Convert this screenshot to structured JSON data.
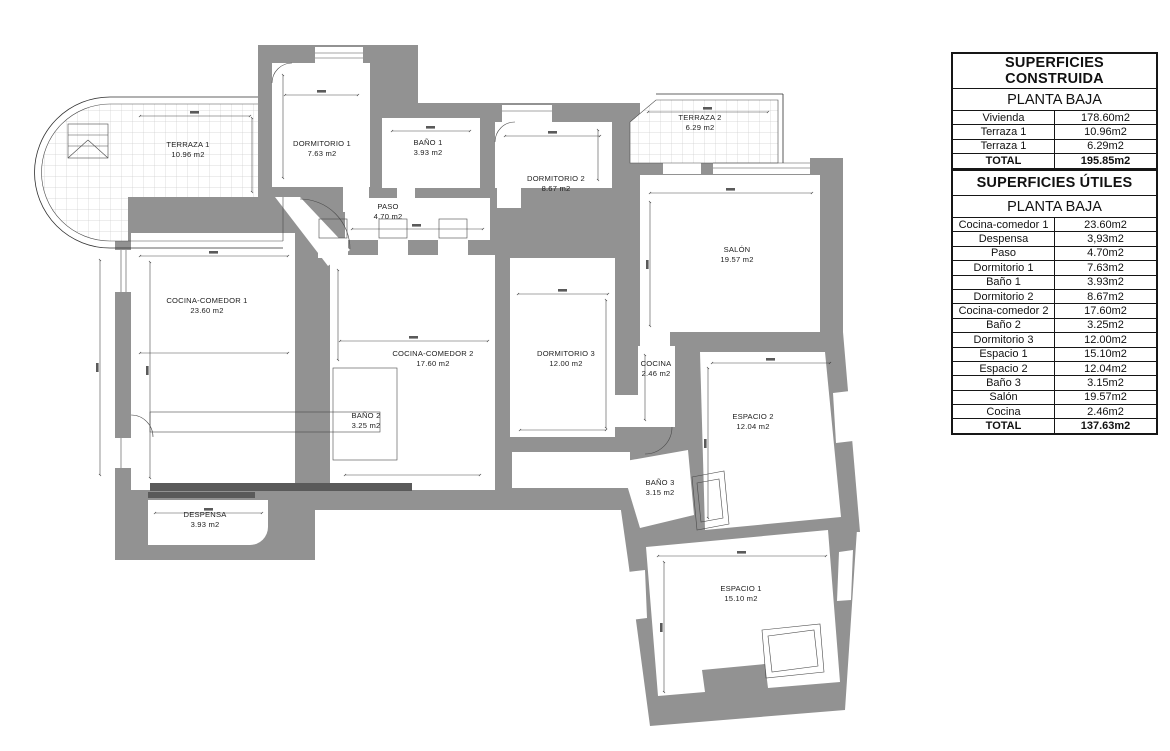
{
  "plan": {
    "wall_color": "#929292",
    "line_color": "#2f2f2f",
    "tile_line_color": "#cfcfcf",
    "rooms": [
      {
        "name": "TERRAZA 1",
        "area": "10.96 m2"
      },
      {
        "name": "DORMITORIO 1",
        "area": "7.63 m2"
      },
      {
        "name": "BAÑO 1",
        "area": "3.93 m2"
      },
      {
        "name": "PASO",
        "area": "4.70 m2"
      },
      {
        "name": "DORMITORIO 2",
        "area": "8.67 m2"
      },
      {
        "name": "TERRAZA 2",
        "area": "6.29 m2"
      },
      {
        "name": "SALÓN",
        "area": "19.57 m2"
      },
      {
        "name": "COCINA-COMEDOR 1",
        "area": "23.60 m2"
      },
      {
        "name": "COCINA-COMEDOR 2",
        "area": "17.60 m2"
      },
      {
        "name": "DORMITORIO 3",
        "area": "12.00 m2"
      },
      {
        "name": "COCINA",
        "area": "2.46 m2"
      },
      {
        "name": "BAÑO 2",
        "area": "3.25 m2"
      },
      {
        "name": "ESPACIO 2",
        "area": "12.04 m2"
      },
      {
        "name": "BAÑO 3",
        "area": "3.15 m2"
      },
      {
        "name": "DESPENSA",
        "area": "3.93 m2"
      },
      {
        "name": "ESPACIO 1",
        "area": "15.10 m2"
      }
    ]
  },
  "tables": {
    "construida": {
      "title": "SUPERFICIES CONSTRUIDA",
      "subtitle": "PLANTA BAJA",
      "rows": [
        {
          "label": "Vivienda",
          "value": "178.60m2"
        },
        {
          "label": "Terraza 1",
          "value": "10.96m2"
        },
        {
          "label": "Terraza 1",
          "value": "6.29m2"
        }
      ],
      "total": {
        "label": "TOTAL",
        "value": "195.85m2"
      }
    },
    "utiles": {
      "title": "SUPERFICIES ÚTILES",
      "subtitle": "PLANTA BAJA",
      "rows": [
        {
          "label": "Cocina-comedor 1",
          "value": "23.60m2"
        },
        {
          "label": "Despensa",
          "value": "3,93m2"
        },
        {
          "label": "Paso",
          "value": "4.70m2"
        },
        {
          "label": "Dormitorio 1",
          "value": "7.63m2"
        },
        {
          "label": "Baño 1",
          "value": "3.93m2"
        },
        {
          "label": "Dormitorio 2",
          "value": "8.67m2"
        },
        {
          "label": "Cocina-comedor 2",
          "value": "17.60m2"
        },
        {
          "label": "Baño 2",
          "value": "3.25m2"
        },
        {
          "label": "Dormitorio 3",
          "value": "12.00m2"
        },
        {
          "label": "Espacio 1",
          "value": "15.10m2"
        },
        {
          "label": "Espacio 2",
          "value": "12.04m2"
        },
        {
          "label": "Baño 3",
          "value": "3.15m2"
        },
        {
          "label": "Salón",
          "value": "19.57m2"
        },
        {
          "label": "Cocina",
          "value": "2.46m2"
        },
        {
          "label": "TOTAL",
          "value": "137.63m2"
        }
      ]
    }
  }
}
